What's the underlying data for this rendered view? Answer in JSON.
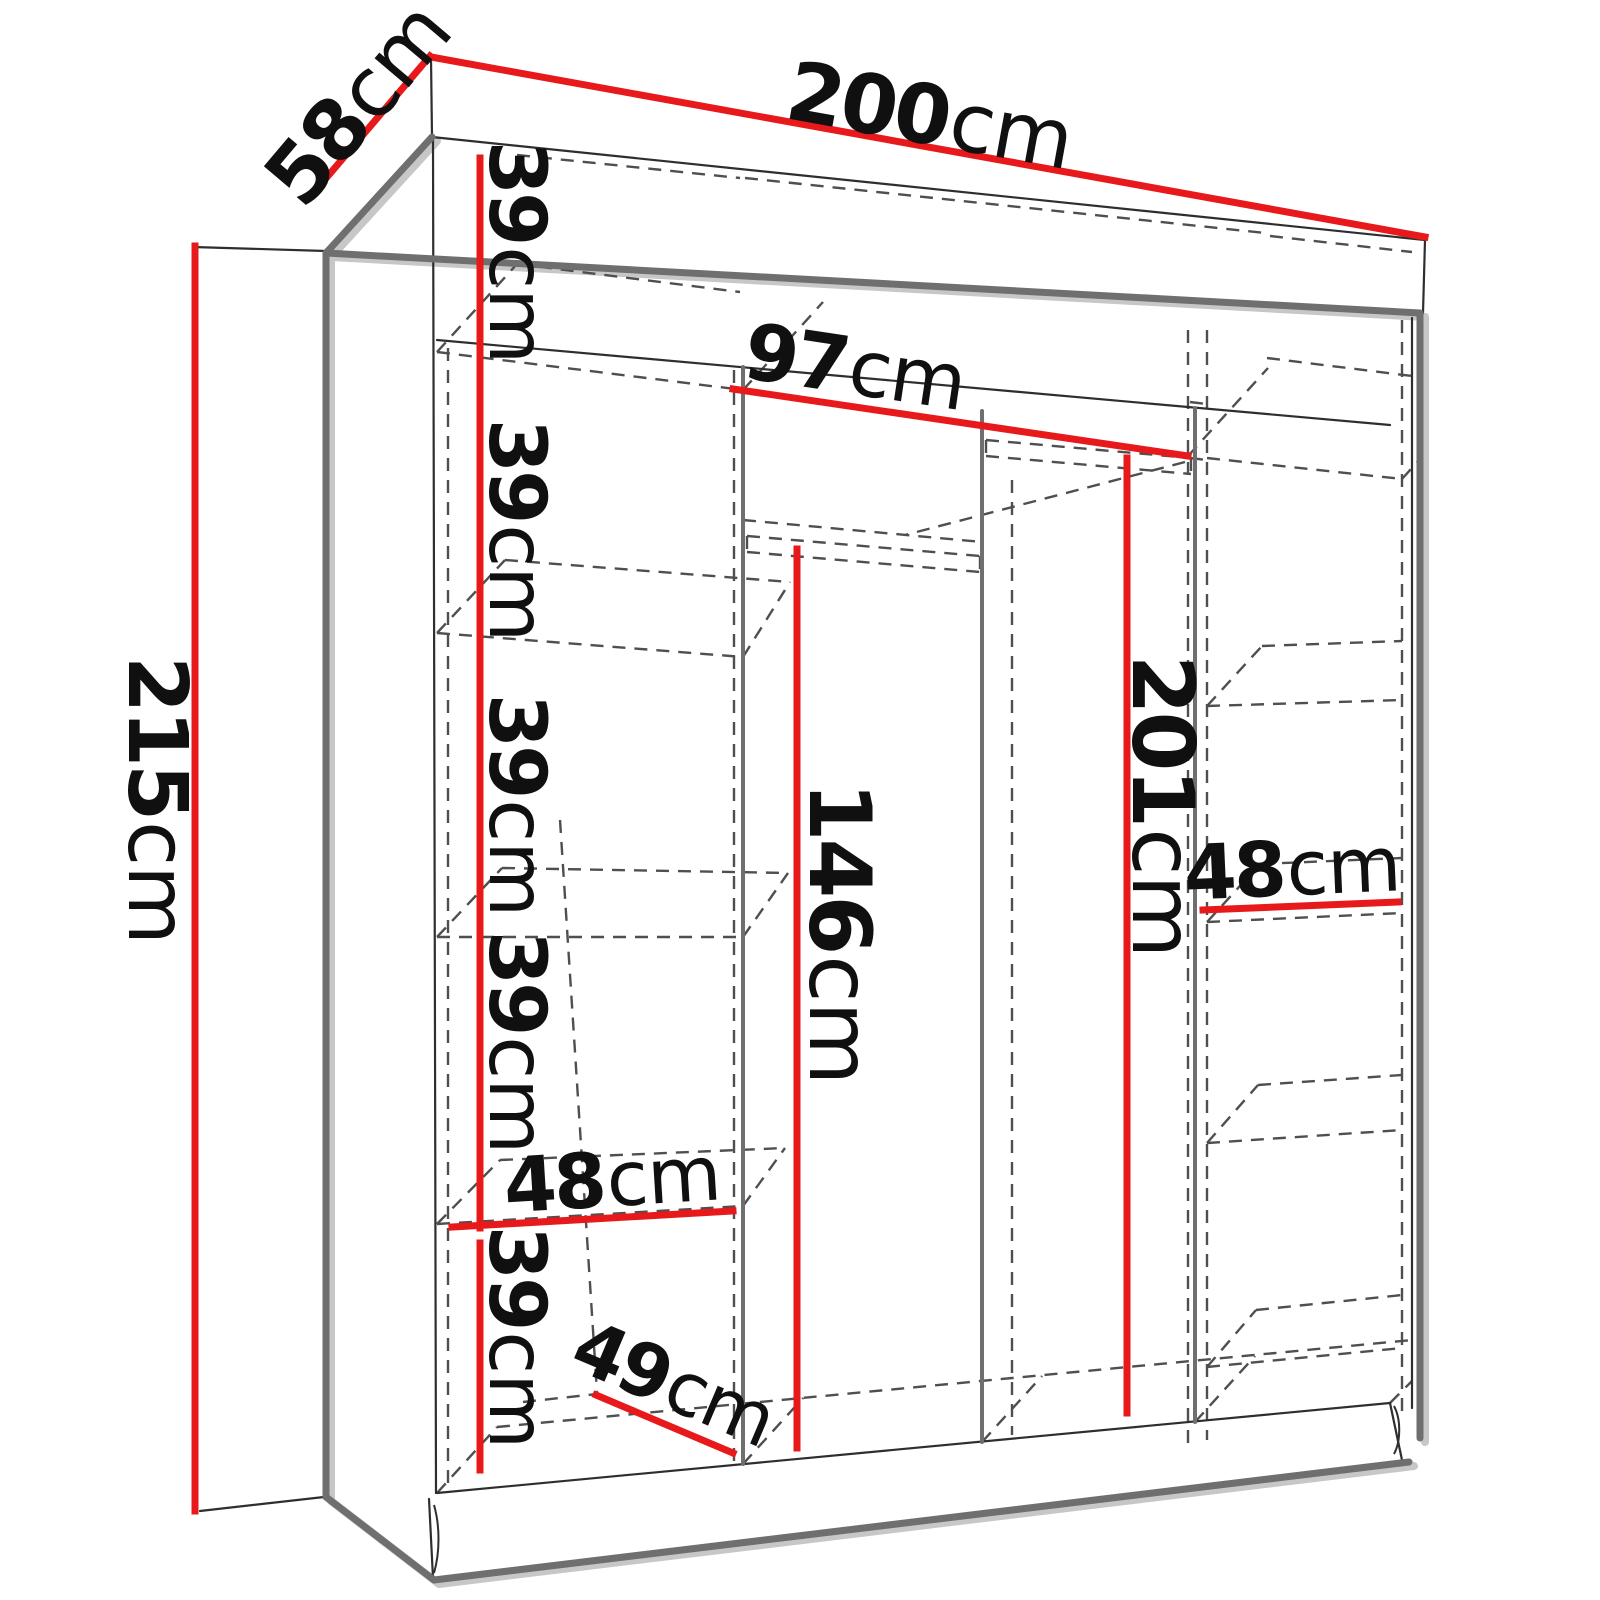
{
  "diagram": {
    "type": "furniture-dimension-diagram",
    "subject": "wardrobe-interior-dimensions",
    "unit": "cm",
    "overall": {
      "width": "200",
      "depth": "58",
      "height": "215"
    },
    "colors": {
      "dimension": "#e8191b",
      "outline": "#6f6f6f",
      "thin": "#2e2e2e",
      "dashed": "#4f4f4f",
      "shadow": "#c7c7c7",
      "text": "#101010",
      "background": "#ffffff"
    },
    "dimensions": [
      {
        "id": "overall-width",
        "value": "200",
        "unit": "cm",
        "line": [
          431,
          57,
          1425,
          237
        ],
        "label": {
          "x": 930,
          "y": 116,
          "rotate": 10.3,
          "size": 82
        }
      },
      {
        "id": "overall-depth",
        "value": "58",
        "unit": "cm",
        "line": [
          322,
          183,
          430,
          56
        ],
        "label": {
          "x": 358,
          "y": 104,
          "rotate": -49.8,
          "size": 82
        }
      },
      {
        "id": "overall-height",
        "value": "215",
        "unit": "cm",
        "line": [
          195,
          246,
          195,
          1511
        ],
        "label": {
          "x": 157,
          "y": 800,
          "rotate": 90,
          "size": 82
        }
      },
      {
        "id": "shelf-gap-1",
        "value": "39",
        "unit": "cm",
        "line": [
          480,
          158,
          480,
          371
        ],
        "label": {
          "x": 516,
          "y": 252,
          "rotate": 90,
          "size": 78
        }
      },
      {
        "id": "shelf-gap-2",
        "value": "39",
        "unit": "cm",
        "line": [
          480,
          377,
          480,
          637
        ],
        "label": {
          "x": 516,
          "y": 530,
          "rotate": 90,
          "size": 78
        }
      },
      {
        "id": "shelf-gap-3",
        "value": "39",
        "unit": "cm",
        "line": [
          480,
          644,
          480,
          934
        ],
        "label": {
          "x": 516,
          "y": 805,
          "rotate": 90,
          "size": 78
        }
      },
      {
        "id": "shelf-gap-4",
        "value": "39",
        "unit": "cm",
        "line": [
          480,
          940,
          480,
          1228
        ],
        "label": {
          "x": 516,
          "y": 1042,
          "rotate": 90,
          "size": 78
        }
      },
      {
        "id": "shelf-gap-5",
        "value": "39",
        "unit": "cm",
        "line": [
          480,
          1243,
          480,
          1470
        ],
        "label": {
          "x": 516,
          "y": 1337,
          "rotate": 90,
          "size": 78
        }
      },
      {
        "id": "middle-width",
        "value": "97",
        "unit": "cm",
        "line": [
          733,
          389,
          1188,
          456
        ],
        "label": {
          "x": 855,
          "y": 368,
          "rotate": 8.5,
          "size": 78
        }
      },
      {
        "id": "tall-hanging-height",
        "value": "201",
        "unit": "cm",
        "line": [
          1127,
          458,
          1127,
          1413
        ],
        "label": {
          "x": 1162,
          "y": 806,
          "rotate": 90,
          "size": 86
        }
      },
      {
        "id": "short-hanging-height",
        "value": "146",
        "unit": "cm",
        "line": [
          797,
          549,
          797,
          1448
        ],
        "label": {
          "x": 839,
          "y": 933,
          "rotate": 90,
          "size": 86
        }
      },
      {
        "id": "right-column-width",
        "value": "48",
        "unit": "cm",
        "line": [
          1203,
          910,
          1398,
          902
        ],
        "label": {
          "x": 1292,
          "y": 868,
          "rotate": -2.5,
          "size": 76
        }
      },
      {
        "id": "left-column-width",
        "value": "48",
        "unit": "cm",
        "line": [
          452,
          1227,
          733,
          1211
        ],
        "label": {
          "x": 612,
          "y": 1179,
          "rotate": -3.5,
          "size": 76
        }
      },
      {
        "id": "usable-depth",
        "value": "49",
        "unit": "cm",
        "line": [
          596,
          1395,
          733,
          1453
        ],
        "label": {
          "x": 674,
          "y": 1384,
          "rotate": 23,
          "size": 74
        }
      }
    ],
    "structure": {
      "thick": [
        [
          432,
          137,
          326,
          253
        ],
        [
          326,
          253,
          1420,
          313
        ],
        [
          326,
          253,
          326,
          1497
        ],
        [
          326,
          1497,
          434,
          1580
        ],
        [
          434,
          1580,
          1409,
          1462
        ],
        [
          1420,
          313,
          1420,
          1438
        ]
      ],
      "medium": [
        [
          743,
          367,
          743,
          1464
        ],
        [
          982,
          411,
          982,
          1442
        ],
        [
          1195,
          408,
          1195,
          1422
        ]
      ],
      "thin": [
        [
          431,
          57,
          432,
          137
        ],
        [
          432,
          137,
          1425,
          240
        ],
        [
          1425,
          240,
          1423,
          313
        ],
        [
          433,
          140,
          436,
          1493
        ],
        [
          1412,
          318,
          1412,
          1408
        ],
        [
          437,
          340,
          1390,
          425
        ],
        [
          437,
          1493,
          1390,
          1403
        ],
        [
          193,
          247,
          326,
          251
        ],
        [
          200,
          1511,
          324,
          1497
        ],
        [
          429,
          1499,
          433,
          1578
        ],
        [
          1390,
          1403,
          1402,
          1460
        ]
      ],
      "paths": [
        "M434,1505 C440,1526 440,1552 434,1573",
        "M1394,1406 C1401,1419 1401,1441 1394,1454"
      ],
      "dashed": [
        [
          448,
          348,
          448,
          1491
        ],
        [
          734,
          370,
          734,
          1462
        ],
        [
          1012,
          480,
          1012,
          1435
        ],
        [
          1188,
          330,
          1188,
          1443
        ],
        [
          1207,
          330,
          1207,
          1440
        ],
        [
          1402,
          320,
          1402,
          1420
        ],
        [
          560,
          820,
          597,
          1392
        ],
        [
          437,
          352,
          743,
          390
        ],
        [
          743,
          390,
          1188,
          456
        ],
        [
          1207,
          458,
          1402,
          479
        ],
        [
          517,
          264,
          740,
          292
        ],
        [
          1267,
          358,
          1420,
          377
        ],
        [
          437,
          352,
          517,
          264
        ],
        [
          743,
          390,
          823,
          302
        ],
        [
          1188,
          456,
          1268,
          368
        ],
        [
          1402,
          479,
          1420,
          459
        ],
        [
          517,
          155,
          740,
          178
        ],
        [
          745,
          178,
          1265,
          233
        ],
        [
          1270,
          236,
          1412,
          252
        ],
        [
          437,
          633,
          743,
          657
        ],
        [
          437,
          633,
          505,
          560
        ],
        [
          505,
          560,
          790,
          582
        ],
        [
          743,
          657,
          790,
          582
        ],
        [
          437,
          937,
          743,
          937
        ],
        [
          437,
          937,
          502,
          868
        ],
        [
          502,
          868,
          788,
          873
        ],
        [
          743,
          937,
          788,
          873
        ],
        [
          437,
          1224,
          743,
          1206
        ],
        [
          437,
          1224,
          500,
          1160
        ],
        [
          500,
          1160,
          785,
          1148
        ],
        [
          743,
          1206,
          785,
          1148
        ],
        [
          1207,
          706,
          1402,
          700
        ],
        [
          1207,
          706,
          1262,
          646
        ],
        [
          1262,
          646,
          1402,
          641
        ],
        [
          1207,
          922,
          1402,
          913
        ],
        [
          1207,
          922,
          1260,
          864
        ],
        [
          1260,
          864,
          1402,
          858
        ],
        [
          1207,
          1143,
          1402,
          1130
        ],
        [
          1207,
          1143,
          1258,
          1085
        ],
        [
          1258,
          1085,
          1402,
          1075
        ],
        [
          1207,
          1367,
          1402,
          1348
        ],
        [
          1207,
          1367,
          1256,
          1310
        ],
        [
          1256,
          1310,
          1402,
          1295
        ],
        [
          747,
          536,
          980,
          556
        ],
        [
          747,
          552,
          980,
          572
        ],
        [
          747,
          536,
          747,
          552
        ],
        [
          980,
          556,
          980,
          572
        ],
        [
          743,
          520,
          982,
          542
        ],
        [
          986,
          440,
          1191,
          458
        ],
        [
          986,
          456,
          1191,
          474
        ],
        [
          986,
          440,
          986,
          456
        ],
        [
          1191,
          458,
          1191,
          474
        ],
        [
          1190,
          402,
          1207,
          404
        ],
        [
          1190,
          458,
          1207,
          460
        ],
        [
          1185,
          462,
          905,
          535
        ],
        [
          497,
          1427,
          1412,
          1340
        ],
        [
          437,
          1493,
          497,
          1427
        ],
        [
          743,
          1464,
          803,
          1398
        ],
        [
          982,
          1442,
          1042,
          1376
        ],
        [
          1195,
          1422,
          1255,
          1356
        ],
        [
          1390,
          1403,
          1412,
          1381
        ],
        [
          523,
          1402,
          597,
          1394
        ]
      ]
    }
  }
}
